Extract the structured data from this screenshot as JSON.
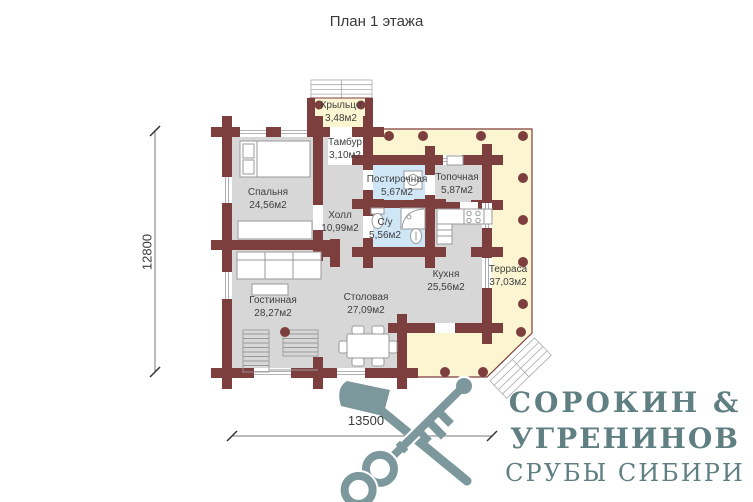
{
  "title": "План 1 этажа",
  "rooms": [
    {
      "name": "Крыльцо",
      "area": "3,48м2"
    },
    {
      "name": "Тамбур",
      "area": "3,10м2"
    },
    {
      "name": "Спальня",
      "area": "24,56м2"
    },
    {
      "name": "Холл",
      "area": "10,99м2"
    },
    {
      "name": "Постирочная",
      "area": "5,67м2"
    },
    {
      "name": "Топочная",
      "area": "5,87м2"
    },
    {
      "name": "С/у",
      "area": "5,56м2"
    },
    {
      "name": "Кухня",
      "area": "25,56м2"
    },
    {
      "name": "Терраса",
      "area": "37,03м2"
    },
    {
      "name": "Гостинная",
      "area": "28,27м2"
    },
    {
      "name": "Столовая",
      "area": "27,09м2"
    }
  ],
  "dimensions": {
    "height_mm": "12800",
    "width_mm": "13500"
  },
  "logo": {
    "line1": "СОРОКИН &",
    "line2": "УГРЕНИНОВ",
    "line3": "СРУБЫ СИБИРИ"
  },
  "colors": {
    "wall": "#7d3e3e",
    "floor_gray": "#d7d7d8",
    "terrace_yellow": "#fbf5d2",
    "wet_room_blue": "#cfe6f7",
    "logo_icon": "#7d989c",
    "logo_text": "#5f7f82",
    "label_text": "#3f3f3f"
  }
}
